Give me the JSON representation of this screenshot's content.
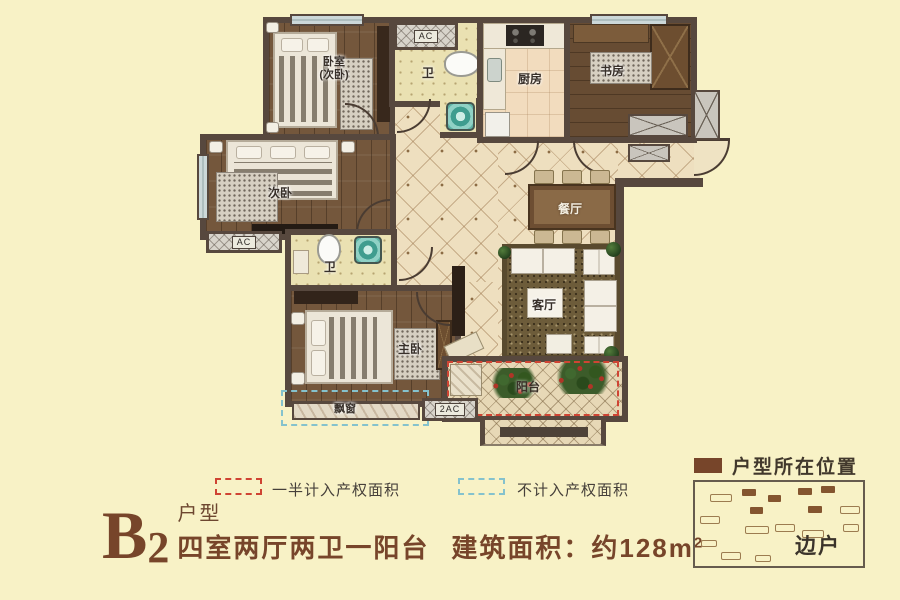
{
  "title": {
    "code": "B",
    "code_sub": "2",
    "type": "户型",
    "layout": "四室两厅两卫一阳台",
    "area_prefix": "建筑面积：约128m",
    "area_sup": "2"
  },
  "legend": {
    "half_area": "一半计入产权面积",
    "excluded_area": "不计入产权面积"
  },
  "location": {
    "heading": "户型所在位置",
    "side_label": "边户"
  },
  "plan": {
    "rooms": {
      "bedroom1_line1": "卧室",
      "bedroom1_line2": "(次卧)",
      "bath1": "卫",
      "kitchen": "厨房",
      "study": "书房",
      "bedroom2": "次卧",
      "bath2": "卫",
      "master": "主卧",
      "dining": "餐厅",
      "living": "客厅",
      "balcony": "阳台",
      "bay_window": "飘窗"
    },
    "ac": {
      "top": "AC",
      "left": "AC",
      "right": "2AC"
    }
  },
  "colors": {
    "background": "#f8f2c6",
    "wall": "#57483e",
    "half_dash_red": "#cf4433",
    "excluded_dash_blue": "#85c2cd",
    "brand_brown": "#77452a"
  }
}
